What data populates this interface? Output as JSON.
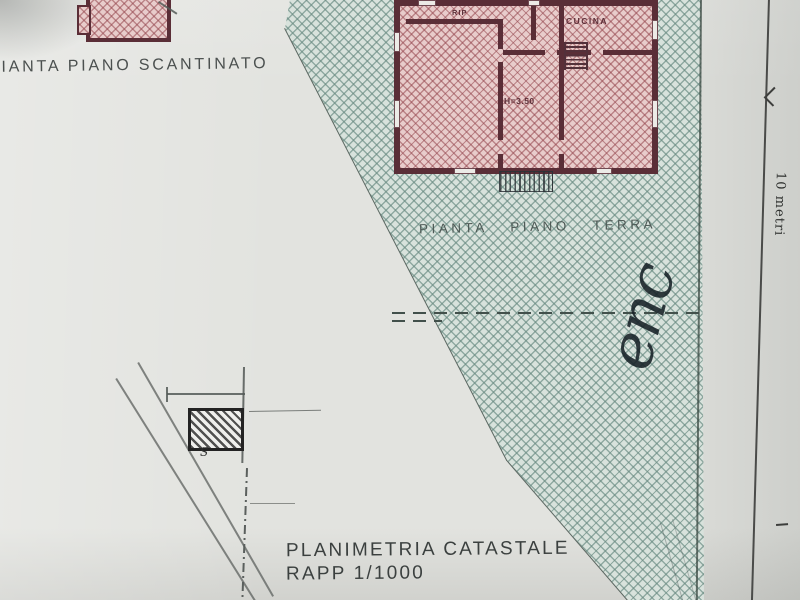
{
  "labels": {
    "basement_plan_title": "PIANTA PIANO SCANTINATO",
    "ground_plan_title": "PIANTA PIANO TERRA",
    "cadastral_title_line1": "PLANIMETRIA CATASTALE",
    "cadastral_title_line2": "RAPP 1/1000",
    "scale_bar": "10 metri",
    "handwritten_note": "enc",
    "footprint_label": "S"
  },
  "ground_plan_rooms": {
    "storage": "RIP",
    "kitchen": "CUCINA",
    "ceiling_height": "H=3.50"
  },
  "colors": {
    "paper": "#e2e3df",
    "parcel_hatch_line": "#688a81",
    "building_wall": "#5a2e37",
    "building_fill": "#e8cccb",
    "ink": "#3b403f"
  }
}
